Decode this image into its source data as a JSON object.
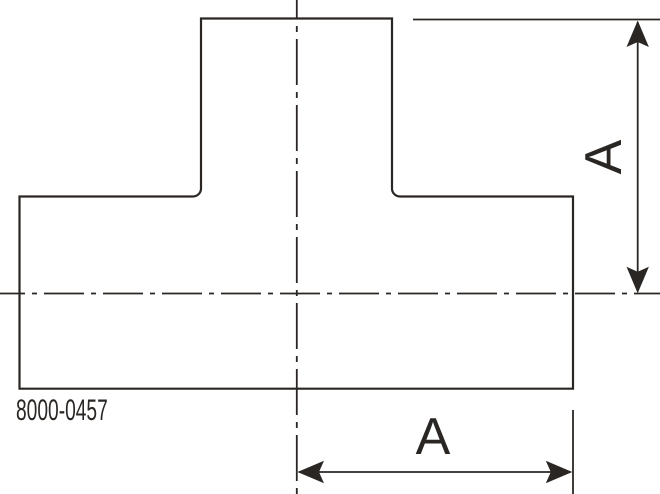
{
  "drawing": {
    "type_label": "technical-drawing-tee-fitting",
    "part_number": "8000-0457",
    "dimensions": {
      "vertical_label": "A",
      "horizontal_label": "A"
    },
    "colors": {
      "line": "#2a2624",
      "background": "#ffffff"
    }
  }
}
